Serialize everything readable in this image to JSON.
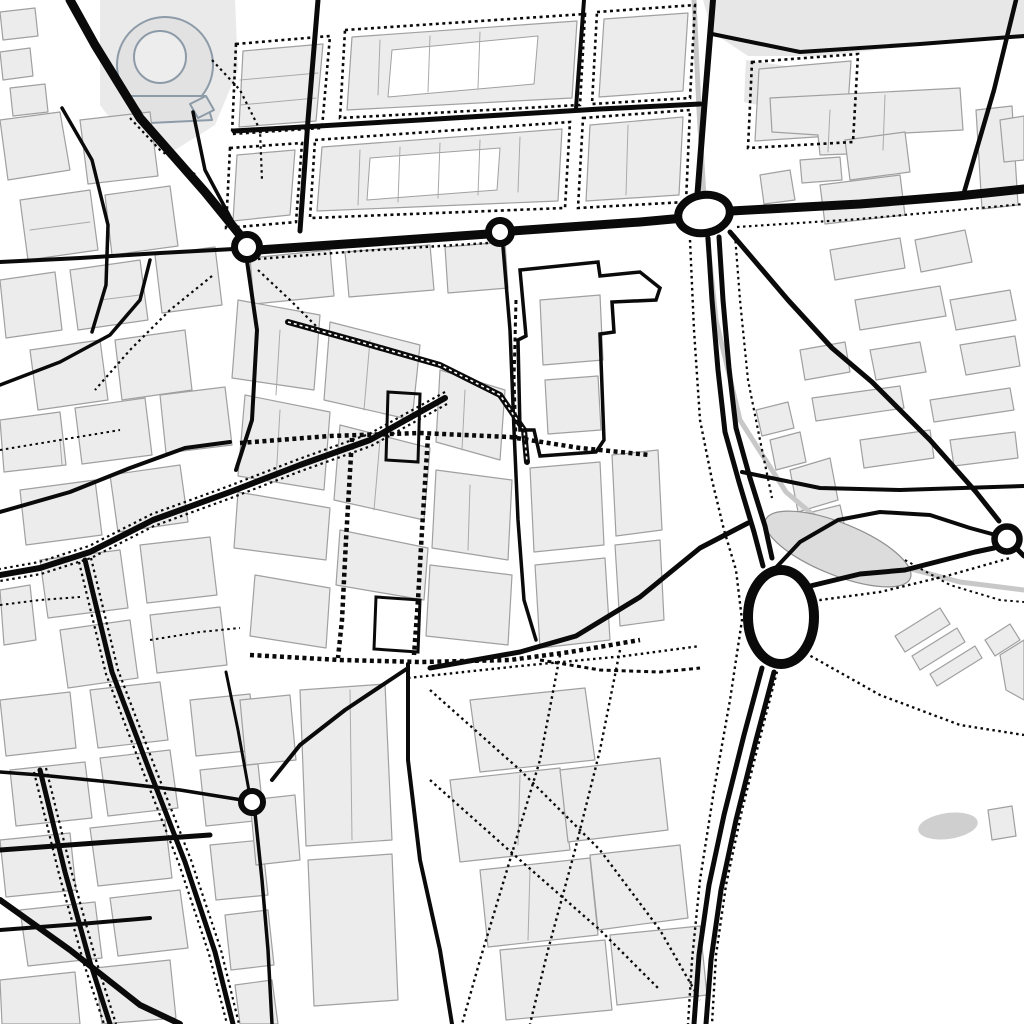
{
  "canvas": {
    "w": 1024,
    "h": 1024,
    "bg": "#ffffff"
  },
  "palette": {
    "road": "#0a0a0a",
    "dot": "#0a0a0a",
    "building_fill": "#ececec",
    "building_stroke": "#a0a0a0",
    "wash_fill": "#e7e7e7",
    "rail": "#c8c8c8",
    "park_fill": "#dcdcdc",
    "park_stroke": "#8f8f8f",
    "landmark_fill": "#e2e2e2",
    "landmark_stroke": "#8d9ba8",
    "white": "#ffffff",
    "parcel": "#aaaaaa",
    "parking_fill": "#cfcfcf"
  },
  "areas": [
    {
      "name": "riverbank-wash-topright",
      "p": "703,0 1024,0 1024,36 930,44 820,56 748,56 712,32",
      "fill": "#e7e7e7"
    },
    {
      "name": "wash-topright-2",
      "p": "746,60 800,68 792,112 744,102",
      "fill": "#e7e7e7"
    },
    {
      "name": "bullring-block-wash",
      "p": "100,0 235,0 238,70 215,125 175,150 130,145 100,105",
      "fill": "#eaeaea"
    }
  ],
  "landmark": {
    "outer": {
      "cx": 165,
      "cy": 65,
      "r": 48
    },
    "apron": "128,96 205,96 212,120 150,123",
    "inner": {
      "cx": 160,
      "cy": 57,
      "r": 26
    },
    "tab": "190,104 206,96 214,110 198,118"
  },
  "block_outlines": [
    {
      "p": "236,44 330,36 322,128 232,134"
    },
    {
      "p": "345,30 585,14 580,105 340,118"
    },
    {
      "p": "597,12 695,5 690,98 592,104"
    },
    {
      "p": "230,148 302,143 296,222 226,228"
    },
    {
      "p": "315,140 570,122 565,208 310,218"
    },
    {
      "p": "583,118 690,110 686,202 578,208"
    },
    {
      "p": "752,62 858,54 853,142 748,148"
    }
  ],
  "buildings": [
    {
      "p": "243,51 323,44 316,121 239,127"
    },
    {
      "p": "352,37 577,21 572,98 347,110"
    },
    {
      "p": "604,19 688,13 683,91 599,97"
    },
    {
      "p": "237,155 295,150 290,215 233,221"
    },
    {
      "p": "322,147 562,129 558,201 317,211"
    },
    {
      "p": "590,125 683,117 679,195 586,201"
    },
    {
      "p": "759,69 851,61 846,135 755,141"
    },
    {
      "p": "770,98 960,88 963,130 905,133 903,152 820,155 818,135 772,132"
    },
    {
      "p": "976,110 1012,106 1018,205 982,209"
    },
    {
      "p": "800,160 840,157 842,180 802,183"
    },
    {
      "p": "760,175 790,170 795,200 764,204"
    },
    {
      "p": "1000,120 1024,116 1024,160 1004,162"
    },
    {
      "p": "845,140 905,132 910,172 850,180"
    },
    {
      "p": "820,185 900,175 905,215 825,224"
    },
    {
      "p": "830,250 900,238 905,268 835,280"
    },
    {
      "p": "915,240 965,230 972,262 921,272"
    },
    {
      "p": "855,300 940,286 946,316 860,330"
    },
    {
      "p": "800,350 845,342 850,372 805,380"
    },
    {
      "p": "870,350 920,342 926,372 876,380"
    },
    {
      "p": "950,300 1010,290 1016,320 956,330"
    },
    {
      "p": "960,345 1015,336 1020,366 966,375"
    },
    {
      "p": "812,398 900,386 904,408 816,421"
    },
    {
      "p": "930,400 1010,388 1014,410 934,422"
    },
    {
      "p": "860,440 930,430 934,458 864,468"
    },
    {
      "p": "950,440 1015,432 1018,458 954,466"
    },
    {
      "p": "756,410 788,402 794,428 762,436"
    },
    {
      "p": "770,440 800,432 806,462 776,470"
    },
    {
      "p": "790,470 830,458 838,500 798,512"
    },
    {
      "p": "800,515 840,505 846,532 806,542"
    },
    {
      "p": "0,12 35,8 38,36 3,40"
    },
    {
      "p": "0,52 30,48 33,76 3,80"
    },
    {
      "p": "10,88 45,84 48,112 13,116"
    },
    {
      "p": "0,120 60,112 70,170 8,180"
    },
    {
      "p": "80,120 150,112 158,176 88,184"
    },
    {
      "p": "20,200 90,190 98,250 28,260"
    },
    {
      "p": "105,195 170,186 178,246 112,255"
    },
    {
      "p": "0,280 55,272 62,330 6,338"
    },
    {
      "p": "70,270 140,260 148,320 78,330"
    },
    {
      "p": "155,255 215,247 222,305 162,313"
    },
    {
      "p": "30,350 100,340 108,400 38,410"
    },
    {
      "p": "115,340 185,330 192,390 122,400"
    },
    {
      "p": "0,420 60,412 66,465 4,472"
    },
    {
      "p": "75,408 145,398 152,455 82,464"
    },
    {
      "p": "160,395 225,387 232,445 166,453"
    },
    {
      "p": "20,490 95,480 102,535 26,545"
    },
    {
      "p": "110,475 180,465 188,522 118,532"
    },
    {
      "p": "40,560 120,550 128,608 48,618"
    },
    {
      "p": "140,545 210,537 217,595 147,603"
    },
    {
      "p": "0,590 30,585 36,640 4,645"
    },
    {
      "p": "60,630 130,620 138,678 68,688"
    },
    {
      "p": "150,615 220,607 227,665 157,673"
    },
    {
      "p": "0,700 70,692 76,748 6,756"
    },
    {
      "p": "90,690 160,682 168,740 98,748"
    },
    {
      "p": "10,770 85,762 92,818 16,826"
    },
    {
      "p": "100,758 170,750 178,808 108,816"
    },
    {
      "p": "0,840 70,833 76,890 6,897"
    },
    {
      "p": "90,828 165,820 172,878 98,886"
    },
    {
      "p": "20,910 95,902 102,958 28,966"
    },
    {
      "p": "110,898 180,890 188,948 118,956"
    },
    {
      "p": "0,980 75,972 80,1024 2,1024"
    },
    {
      "p": "95,968 170,960 176,1018 102,1024"
    },
    {
      "p": "190,700 250,694 256,750 196,756"
    },
    {
      "p": "200,770 258,764 264,820 206,826"
    },
    {
      "p": "210,845 262,840 268,895 216,900"
    },
    {
      "p": "225,915 268,910 274,965 231,970"
    },
    {
      "p": "235,985 272,980 278,1024 240,1024"
    },
    {
      "p": "250,258 330,250 334,296 254,304"
    },
    {
      "p": "345,252 430,245 434,290 349,297"
    },
    {
      "p": "445,247 505,242 508,288 448,293"
    },
    {
      "p": "238,300 320,315 314,390 232,378"
    },
    {
      "p": "330,322 420,345 412,420 324,400"
    },
    {
      "p": "245,395 330,412 324,490 238,476"
    },
    {
      "p": "340,425 430,448 424,520 334,500"
    },
    {
      "p": "238,492 330,508 326,560 234,548"
    },
    {
      "p": "340,530 428,548 424,600 336,585"
    },
    {
      "p": "255,575 330,588 326,648 250,636"
    },
    {
      "p": "440,370 505,390 500,460 436,442"
    },
    {
      "p": "436,470 512,480 508,560 432,548"
    },
    {
      "p": "430,565 512,575 508,645 426,636"
    },
    {
      "p": "530,468 600,462 604,545 534,552"
    },
    {
      "p": "612,455 658,450 662,530 616,536"
    },
    {
      "p": "535,565 605,558 610,640 540,648"
    },
    {
      "p": "615,545 660,540 664,620 620,626"
    },
    {
      "p": "540,300 600,295 603,360 543,365"
    },
    {
      "p": "545,380 598,376 601,430 548,434"
    },
    {
      "p": "470,700 585,688 595,760 480,772"
    },
    {
      "p": "450,780 560,768 570,850 460,862"
    },
    {
      "p": "560,770 660,758 668,830 568,842"
    },
    {
      "p": "480,870 590,858 598,935 488,947"
    },
    {
      "p": "590,855 680,845 688,918 598,930"
    },
    {
      "p": "500,950 605,940 612,1010 506,1020"
    },
    {
      "p": "610,935 700,926 707,995 617,1005"
    },
    {
      "p": "300,690 385,684 392,840 306,846"
    },
    {
      "p": "308,860 392,854 398,1000 314,1006"
    },
    {
      "p": "240,700 290,695 296,760 246,765"
    },
    {
      "p": "250,800 295,795 300,860 256,865"
    },
    {
      "p": "895,636 940,608 950,624 905,652"
    },
    {
      "p": "912,656 957,628 965,642 920,670"
    },
    {
      "p": "930,674 975,646 982,658 937,686"
    },
    {
      "p": "985,640 1010,624 1020,640 995,656"
    },
    {
      "p": "1000,655 1024,640 1024,700 1006,690"
    },
    {
      "p": "988,810 1012,806 1016,836 992,840"
    }
  ],
  "courtyards": [
    {
      "p": "392,50 538,36 534,84 388,97"
    },
    {
      "p": "370,158 500,148 497,190 367,200"
    }
  ],
  "parcel_lines": [
    {
      "p": "240,80 318,73"
    },
    {
      "p": "240,105 316,98"
    },
    {
      "p": "380,40 378,95"
    },
    {
      "p": "430,36 428,92"
    },
    {
      "p": "480,32 478,88"
    },
    {
      "p": "360,150 358,205"
    },
    {
      "p": "400,147 398,202"
    },
    {
      "p": "440,143 438,198"
    },
    {
      "p": "480,140 478,195"
    },
    {
      "p": "520,137 518,192"
    },
    {
      "p": "628,125 626,195"
    },
    {
      "p": "30,230 90,222"
    },
    {
      "p": "100,300 140,295"
    },
    {
      "p": "60,440 62,465"
    },
    {
      "p": "280,330 276,395"
    },
    {
      "p": "370,340 364,410"
    },
    {
      "p": "280,410 276,480"
    },
    {
      "p": "380,440 374,510"
    },
    {
      "p": "465,390 462,450"
    },
    {
      "p": "470,485 468,550"
    },
    {
      "p": "520,775 518,845"
    },
    {
      "p": "530,870 528,940"
    },
    {
      "p": "350,690 352,840"
    },
    {
      "p": "830,110 828,152"
    },
    {
      "p": "885,95 883,150"
    }
  ],
  "rails": [
    {
      "p": "694,0 699,110 705,215 716,320 740,420 786,492 838,536 900,566 960,582 1024,590",
      "w": 5
    }
  ],
  "park": {
    "cx": 838,
    "cy": 549,
    "rx": 78,
    "ry": 26,
    "rot": 22
  },
  "parking": {
    "cx": 948,
    "cy": 826,
    "rx": 30,
    "ry": 13,
    "rot": -8
  },
  "roads": [
    {
      "p": "70,0 95,45 140,118 205,192 240,235",
      "w": 9
    },
    {
      "p": "258,250 360,243 488,234",
      "w": 9
    },
    {
      "p": "512,231 640,222 684,218",
      "w": 9
    },
    {
      "p": "731,211 860,204 958,196 1024,189",
      "w": 9
    },
    {
      "p": "708,238 712,300 718,370 725,432 739,482 754,532 763,566",
      "w": 5
    },
    {
      "p": "719,237 723,300 729,368 736,428 750,478 765,526 772,558",
      "w": 5
    },
    {
      "p": "762,668 744,735 724,815 709,885 699,955 694,1024",
      "w": 5
    },
    {
      "p": "774,672 756,740 736,820 721,890 711,960 706,1024",
      "w": 5
    },
    {
      "p": "318,0 308,120 300,231",
      "w": 5
    },
    {
      "p": "584,0 576,108",
      "w": 4
    },
    {
      "p": "713,0 704,110 697,200",
      "w": 6
    },
    {
      "p": "234,131 420,120 600,109 700,104",
      "w": 5
    },
    {
      "p": "193,112 205,170 237,230",
      "w": 3.5
    },
    {
      "p": "247,261 257,330 252,420 236,470",
      "w": 4
    },
    {
      "p": "234,249 160,253 80,258 0,262",
      "w": 4
    },
    {
      "p": "288,322 360,342 440,365 500,395 524,430 527,462",
      "w": 6
    },
    {
      "p": "503,247 510,330 514,430 518,520 524,600 536,640",
      "w": 3.5
    },
    {
      "p": "748,523 700,548 640,597 576,636 520,652 430,668",
      "w": 5
    },
    {
      "p": "408,664 408,760 420,860 440,950 452,1024",
      "w": 4
    },
    {
      "p": "408,668 345,710 300,745 272,780",
      "w": 4
    },
    {
      "p": "242,800 180,790 110,782 40,775 0,772",
      "w": 3.5
    },
    {
      "p": "255,813 262,880 268,950 272,1024",
      "w": 3.5
    },
    {
      "p": "249,791 238,730 226,672",
      "w": 3
    },
    {
      "p": "85,560 112,672 150,772 185,862 215,952 233,1024",
      "w": 5
    },
    {
      "p": "40,770 65,872 90,962 110,1024",
      "w": 5
    },
    {
      "p": "0,850 110,842 210,835",
      "w": 5
    },
    {
      "p": "0,930 80,924 150,918",
      "w": 4
    },
    {
      "p": "0,900 70,950 140,1005 180,1024",
      "w": 6
    },
    {
      "p": "445,398 370,440 300,465 230,492 153,520 90,552 40,568 0,575",
      "w": 6
    },
    {
      "p": "730,232 788,300 832,348 872,382 930,440 976,492 999,521",
      "w": 5
    },
    {
      "p": "742,472 820,488 900,490 1024,486",
      "w": 4
    },
    {
      "p": "770,574 800,542 838,520 880,512 930,515 970,528 992,534",
      "w": 4
    },
    {
      "p": "806,587 860,574 905,570 975,552 994,548",
      "w": 5
    },
    {
      "p": "1016,548 1024,556",
      "w": 5
    },
    {
      "p": "712,34 800,52 920,44 1024,36",
      "w": 4
    },
    {
      "p": "1016,0 994,90 963,196",
      "w": 4.5
    },
    {
      "p": "62,108 92,160 108,225 106,285 92,332",
      "w": 3.5
    },
    {
      "p": "0,385 60,362 110,335 140,300 150,260",
      "w": 3.5
    },
    {
      "p": "0,512 70,492 130,468 185,448 230,442",
      "w": 4
    }
  ],
  "road_overlays": [
    {
      "p": "288,322 360,342 440,365 500,395 524,430 527,462",
      "w": 1.6,
      "dash": "3 3"
    }
  ],
  "heavy_outlines": [
    {
      "p": "520,270 598,262 600,276 640,272 660,288 656,300 612,302 614,332 600,334 604,440 596,452 540,456 534,430 520,430 518,340 526,336",
      "w": 3.5
    },
    {
      "p": "376,597 420,600 418,652 374,649",
      "w": 3
    },
    {
      "p": "388,392 420,394 418,462 386,460",
      "w": 3
    }
  ],
  "dashed_bold": [
    {
      "p": "240,443 330,436 420,433 510,437 580,448 650,455",
      "w": 4.5
    },
    {
      "p": "352,438 346,540 342,620 338,658",
      "w": 4.5
    },
    {
      "p": "428,436 422,530 418,600 414,655",
      "w": 4.5
    },
    {
      "p": "250,655 340,660 420,662 510,660 570,652 640,640",
      "w": 4.5
    },
    {
      "p": "516,300 514,380 516,440",
      "w": 3
    },
    {
      "p": "540,660 600,670 660,672 700,668",
      "w": 3
    }
  ],
  "dotted": [
    {
      "p": "212,60 240,90 260,130 262,180",
      "w": 2.2
    },
    {
      "p": "130,118 160,150 196,175",
      "w": 2.2
    },
    {
      "p": "258,259 360,251 488,243",
      "w": 2.4
    },
    {
      "p": "737,227 860,219 1024,204",
      "w": 2.2
    },
    {
      "p": "690,240 694,330 700,420 712,480 724,530 736,570 742,620 730,700 714,790 700,880 692,960 688,1024",
      "w": 2.4
    },
    {
      "p": "735,235 740,300 748,380 760,440 772,498",
      "w": 2.2
    },
    {
      "p": "772,592 820,600 880,592 950,575 1010,558",
      "w": 2.4
    },
    {
      "p": "780,660 762,730 742,810 726,885 716,955 712,1024",
      "w": 2.4
    },
    {
      "p": "800,650 880,695 960,725 1024,735",
      "w": 2.4
    },
    {
      "p": "212,276 170,310 130,350 95,390",
      "w": 2.2
    },
    {
      "p": "258,270 290,300 320,330",
      "w": 2.2
    },
    {
      "p": "79,562 106,674 144,774 179,864 209,954 227,1024",
      "w": 2.2
    },
    {
      "p": "91,558 118,670 156,770 191,860 221,950 239,1024",
      "w": 2.2
    },
    {
      "p": "34,772 59,874 84,964 104,1024",
      "w": 2.2
    },
    {
      "p": "46,768 71,870 96,960 116,1024",
      "w": 2.2
    },
    {
      "p": "445,392 369,434 299,459 229,486 152,514 89,546 39,562 0,569",
      "w": 2.2
    },
    {
      "p": "447,404 371,446 301,471 231,498 154,526 91,558 41,574 0,581",
      "w": 2.2
    },
    {
      "p": "408,678 520,666 625,656 700,646",
      "w": 2.4
    },
    {
      "p": "430,690 520,770 600,850 660,930 700,1000",
      "w": 2.4
    },
    {
      "p": "560,655 540,760 510,860 480,960 462,1024",
      "w": 2.4
    },
    {
      "p": "620,650 600,750 575,850 548,950 530,1024",
      "w": 2.4
    },
    {
      "p": "430,780 520,860 600,930 660,990",
      "w": 2.4
    },
    {
      "p": "0,450 60,440 120,430",
      "w": 2
    },
    {
      "p": "0,605 40,600 80,597",
      "w": 2
    },
    {
      "p": "150,640 200,632 240,628",
      "w": 2
    },
    {
      "p": "905,560 950,585 1000,600 1024,602",
      "w": 2
    }
  ],
  "roundabouts": [
    {
      "cx": 247,
      "cy": 247,
      "rx": 12.5,
      "ry": 12.5,
      "rot": 0,
      "sw": 7
    },
    {
      "cx": 500,
      "cy": 232,
      "rx": 11.5,
      "ry": 11.5,
      "rot": 0,
      "sw": 7
    },
    {
      "cx": 704,
      "cy": 214,
      "rx": 26,
      "ry": 19,
      "rot": -10,
      "sw": 8
    },
    {
      "cx": 781,
      "cy": 617,
      "rx": 33,
      "ry": 47,
      "rot": 0,
      "sw": 10
    },
    {
      "cx": 1007,
      "cy": 539,
      "rx": 12.5,
      "ry": 12.5,
      "rot": 0,
      "sw": 6.5
    },
    {
      "cx": 252,
      "cy": 802,
      "rx": 11,
      "ry": 11,
      "rot": 0,
      "sw": 6
    }
  ]
}
